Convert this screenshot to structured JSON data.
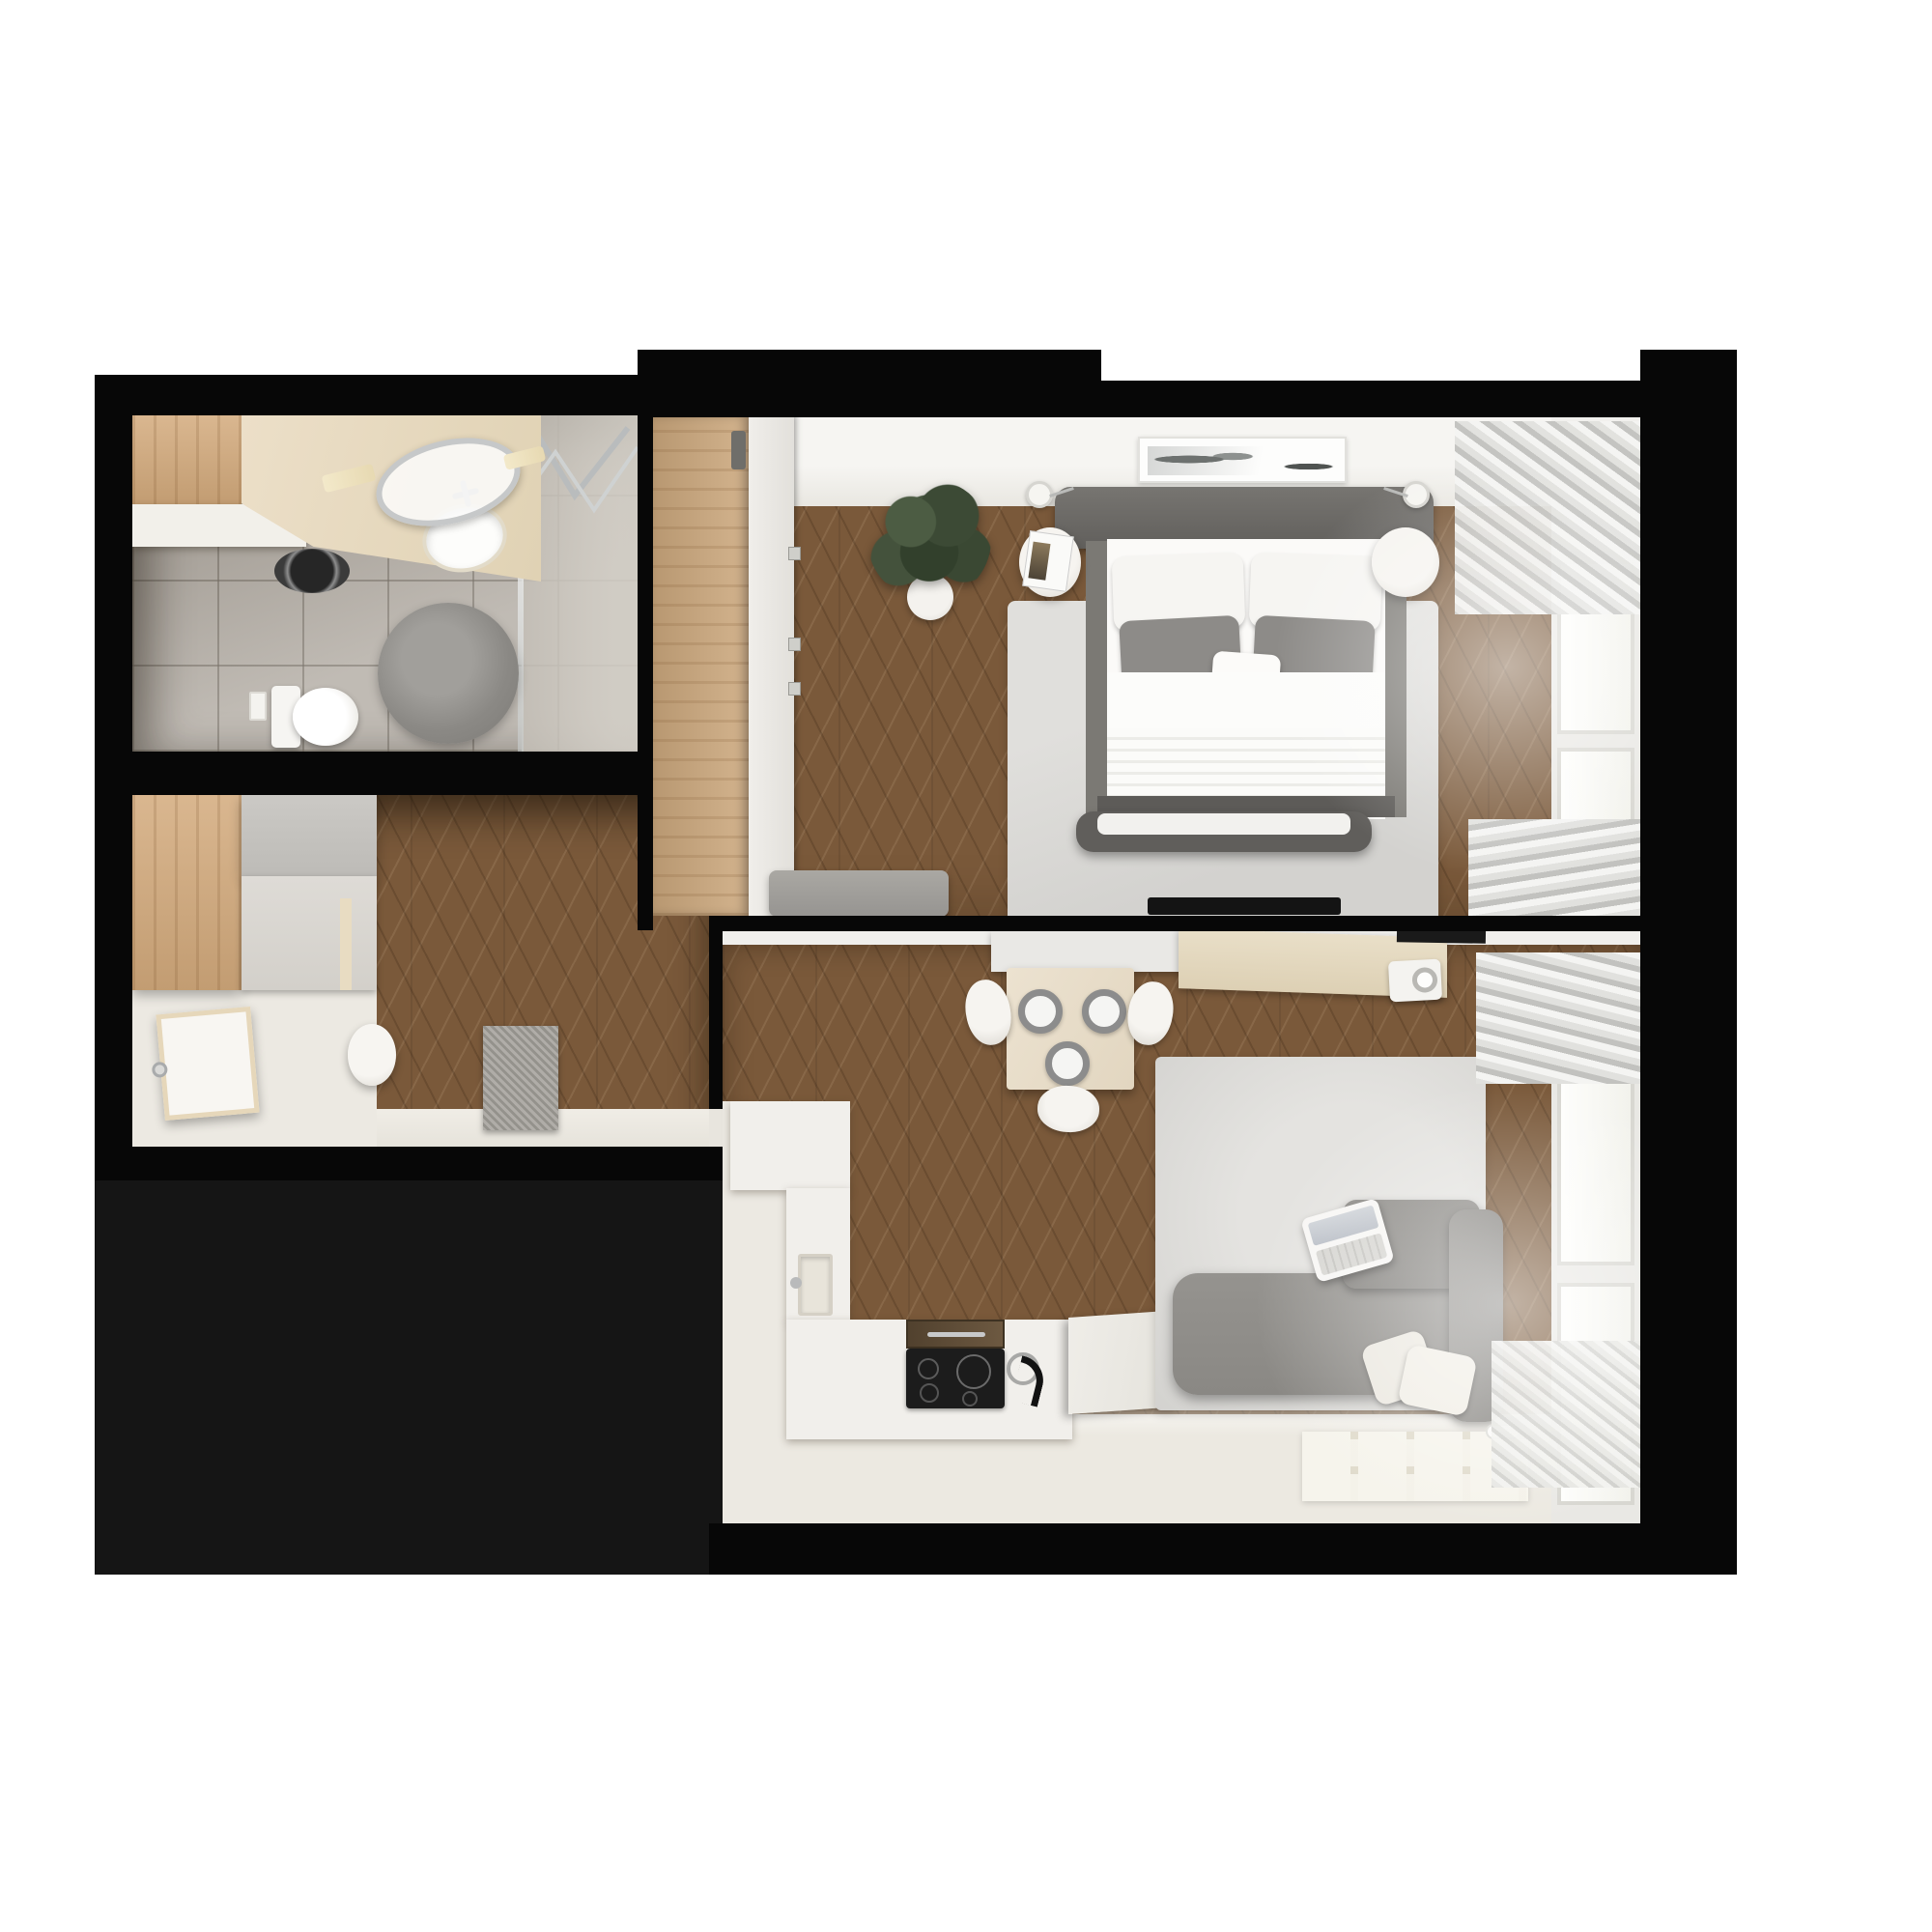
{
  "page": {
    "title": "Top-down 3D rendered floor plan of a small one-bedroom apartment",
    "style": "photorealistic architectural render, no text labels"
  },
  "palette": {
    "wall_black": "#070707",
    "outside_dark_zone": "#151515",
    "chevron_wood_floor": "#7a593a",
    "oak_furniture": "#d3aa7c",
    "bathroom_tile_gray": "#b6b0a8",
    "cream_floor": "#ece9e2",
    "counter_white": "#f1efeb",
    "counter_beige": "#e3d7bf",
    "cooktop_black": "#1c1c1c",
    "sofa_gray": "#908e8a",
    "bed_frame_gray": "#6b6967",
    "rug_light_gray": "#d8d7d4",
    "plant_green": "#3d4b36",
    "background": "#ffffff"
  },
  "rooms": {
    "bathroom": {
      "label": "Bathroom",
      "position": "top-left",
      "items": [
        "oak cabinet",
        "laundry counter",
        "washing machine drum",
        "beige vanity",
        "oval sink with chrome faucet",
        "oval chrome mirror",
        "wall sconces",
        "walk-in shower with glass partition",
        "chrome towel rails",
        "round stone rug",
        "wall-hung toilet",
        "flush plate"
      ]
    },
    "hallway": {
      "label": "Entrance hall",
      "position": "middle-left",
      "items": [
        "oak wardrobe",
        "gray sliding-door closet",
        "open entrance door",
        "door handle",
        "white pouf",
        "gray doormat",
        "chevron parquet floor",
        "passage to living room"
      ]
    },
    "bedroom": {
      "label": "Bedroom",
      "position": "top-right",
      "items": [
        "built-in oak wardrobe",
        "white wardrobe door",
        "potted plant",
        "double bed",
        "gray upholstered headboard",
        "two white pillows",
        "two gray pillows",
        "white accent cushion",
        "white duvet",
        "knit throw",
        "dark foot bench",
        "round left nightstand with magazine",
        "round right nightstand",
        "two wall lamps",
        "abstract framed art",
        "light gray area rug",
        "gray media console",
        "wall-mounted TV",
        "window wall with curtains"
      ]
    },
    "living_kitchen": {
      "label": "Living room with kitchenette",
      "position": "bottom-right",
      "items": [
        "L-shaped white kitchen counter",
        "small square sink",
        "induction cooktop with four burners",
        "dark wood extractor inset",
        "black arc faucet with chrome ring",
        "raised bar slab",
        "upper white counter",
        "upper beige counter",
        "countertop appliance with round door",
        "black wall shelf",
        "square dining table for three",
        "three gray place settings",
        "three white chairs",
        "gray corner sofa",
        "open laptop on sofa back",
        "two cream sofa pillows",
        "light gray area rug",
        "tiled cream accent rug",
        "window wall with curtains",
        "radiator under window"
      ]
    },
    "outside": {
      "label": "Unlit service area",
      "position": "bottom-left",
      "items": [
        "dark empty zone"
      ]
    }
  }
}
